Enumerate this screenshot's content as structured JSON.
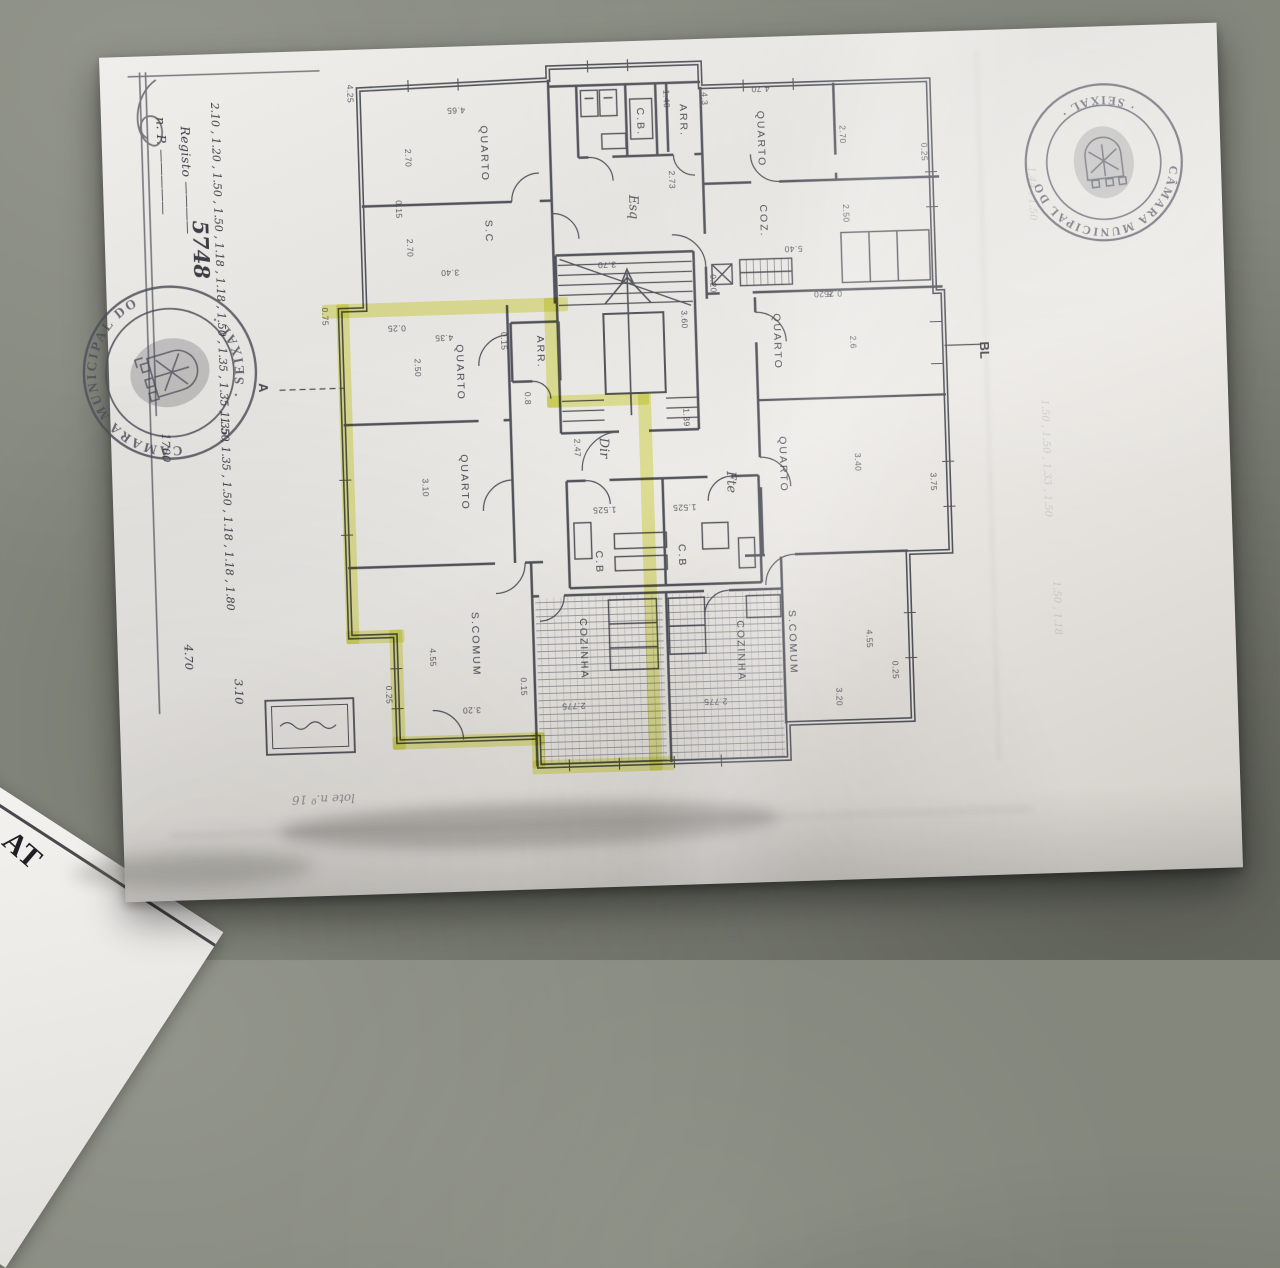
{
  "scene": {
    "description": "photocopied apartment floor plan on grey floor",
    "floor_color": "#84877c",
    "paper_color": "#e8e6e2",
    "ink_color": "#3c3e48",
    "highlight_color": "#dde049"
  },
  "registration": {
    "line1": "n. P.",
    "line2": "Registo",
    "number": "5748"
  },
  "stamps": {
    "left": {
      "arc_top": "CÂMARA MUNICIPAL DO",
      "arc_bottom": "· SEIXAL ·"
    },
    "right": {
      "arc_top": "CÂMARA MUNICIPAL DO",
      "arc_bottom": "· SEIXAL ·"
    }
  },
  "margin": {
    "column_upper": "2.10 , 1.20 , 1.50 , 1.50 , 1.18 , 1.18 , 1.50 , 1.35 , 1.35 , 1.50",
    "column_mid": "1700",
    "column_lower": "1.35 , 1.35 , 1.50 , 1.18 , 1.18 , 1.80",
    "left_bottom_1": "4.70",
    "left_bottom_2": "3.10",
    "faint_notes": [
      {
        "t": "1.50 , 1.50 , 1.33 , 1.50",
        "x": 1046,
        "y": 470
      },
      {
        "t": "1.44 , 1.50",
        "x": 1040,
        "y": 205
      },
      {
        "t": "1.50 , 1.18",
        "x": 1052,
        "y": 620
      }
    ]
  },
  "markers": {
    "section": "A",
    "block": "BL",
    "lot": "lote n.º 16"
  },
  "at_document": {
    "heading": "AT",
    "fragments": [
      "idade",
      "aneir"
    ]
  },
  "plan": {
    "rooms": [
      {
        "t": "QUARTO",
        "x": 494,
        "y": 148,
        "r": 90
      },
      {
        "t": "S.C",
        "x": 496,
        "y": 226,
        "r": 90
      },
      {
        "t": "C.B.",
        "x": 651,
        "y": 121,
        "r": 90
      },
      {
        "t": "ARR.",
        "x": 694,
        "y": 121,
        "r": 90
      },
      {
        "t": "QUARTO",
        "x": 771,
        "y": 142,
        "r": 90
      },
      {
        "t": "COZ.",
        "x": 771,
        "y": 224,
        "r": 90
      },
      {
        "t": "QUARTO",
        "x": 463,
        "y": 366,
        "r": 90
      },
      {
        "t": "QUARTO",
        "x": 464,
        "y": 476,
        "r": 90
      },
      {
        "t": "ARR.",
        "x": 544,
        "y": 348,
        "r": 90
      },
      {
        "t": "QUARTO",
        "x": 781,
        "y": 345,
        "r": 90
      },
      {
        "t": "QUARTO",
        "x": 783,
        "y": 468,
        "r": 90
      },
      {
        "t": "C.B",
        "x": 596,
        "y": 560,
        "r": 90
      },
      {
        "t": "C.B",
        "x": 679,
        "y": 556,
        "r": 90
      },
      {
        "t": "S.COMUM",
        "x": 470,
        "y": 638,
        "r": 90
      },
      {
        "t": "COZINHA",
        "x": 578,
        "y": 646,
        "r": 90
      },
      {
        "t": "COZINHA",
        "x": 735,
        "y": 653,
        "r": 90
      },
      {
        "t": "S.COMUM",
        "x": 787,
        "y": 646,
        "r": 90
      }
    ],
    "dimensions": [
      {
        "t": "4.25",
        "x": 362,
        "y": 84,
        "r": 90
      },
      {
        "t": "4.65",
        "x": 467,
        "y": 104,
        "r": 180
      },
      {
        "t": "2.70",
        "x": 418,
        "y": 150,
        "r": 90
      },
      {
        "t": "0.15",
        "x": 407,
        "y": 201,
        "r": 90
      },
      {
        "t": "2.70",
        "x": 417,
        "y": 240,
        "r": 90
      },
      {
        "t": "3.40",
        "x": 456,
        "y": 266,
        "r": 180
      },
      {
        "t": "1.40",
        "x": 678,
        "y": 99,
        "r": 90
      },
      {
        "t": "2.73",
        "x": 681,
        "y": 180,
        "r": 90
      },
      {
        "t": "4.3",
        "x": 716,
        "y": 100,
        "r": 90
      },
      {
        "t": "4.70",
        "x": 772,
        "y": 92,
        "r": 180
      },
      {
        "t": "2.70",
        "x": 853,
        "y": 140,
        "r": 90
      },
      {
        "t": "5.40",
        "x": 800,
        "y": 253,
        "r": 180
      },
      {
        "t": "2.50",
        "x": 854,
        "y": 219,
        "r": 90
      },
      {
        "t": "0.20",
        "x": 719,
        "y": 285,
        "r": 90
      },
      {
        "t": "6.20",
        "x": 828,
        "y": 299,
        "r": 180
      },
      {
        "t": "0.25",
        "x": 934,
        "y": 160,
        "r": 90
      },
      {
        "t": "3.70",
        "x": 613,
        "y": 263,
        "r": 180
      },
      {
        "t": "3.60",
        "x": 689,
        "y": 320,
        "r": 90
      },
      {
        "t": "1.39",
        "x": 688,
        "y": 418,
        "r": 90
      },
      {
        "t": "0.75",
        "x": 330,
        "y": 306,
        "r": 90
      },
      {
        "t": "0.25",
        "x": 401,
        "y": 320,
        "r": 180
      },
      {
        "t": "4.35",
        "x": 448,
        "y": 331,
        "r": 180
      },
      {
        "t": "2.50",
        "x": 421,
        "y": 360,
        "r": 90
      },
      {
        "t": "0.15",
        "x": 508,
        "y": 336,
        "r": 90
      },
      {
        "t": "0.8",
        "x": 530,
        "y": 394,
        "r": 90
      },
      {
        "t": "3.10",
        "x": 425,
        "y": 480,
        "r": 90
      },
      {
        "t": "0.25",
        "x": 838,
        "y": 299,
        "r": 180
      },
      {
        "t": "2.6",
        "x": 857,
        "y": 348,
        "r": 90
      },
      {
        "t": "3.40",
        "x": 858,
        "y": 468,
        "r": 90
      },
      {
        "t": "3.75",
        "x": 933,
        "y": 490,
        "r": 90
      },
      {
        "t": "2.47",
        "x": 578,
        "y": 445,
        "r": 90
      },
      {
        "t": "1.525",
        "x": 603,
        "y": 508,
        "r": 180
      },
      {
        "t": "1.525",
        "x": 683,
        "y": 508,
        "r": 180
      },
      {
        "t": "4.55",
        "x": 427,
        "y": 650,
        "r": 90
      },
      {
        "t": "0.15",
        "x": 517,
        "y": 682,
        "r": 90
      },
      {
        "t": "3.20",
        "x": 464,
        "y": 704,
        "r": 180
      },
      {
        "t": "2.775",
        "x": 566,
        "y": 703,
        "r": 180
      },
      {
        "t": "2.775",
        "x": 708,
        "y": 703,
        "r": 180
      },
      {
        "t": "4.55",
        "x": 864,
        "y": 645,
        "r": 90
      },
      {
        "t": "0.25",
        "x": 889,
        "y": 677,
        "r": 90
      },
      {
        "t": "3.20",
        "x": 832,
        "y": 702,
        "r": 90
      },
      {
        "t": "0.25",
        "x": 382,
        "y": 686,
        "r": 90
      }
    ],
    "hand_notes": [
      {
        "t": "Esq",
        "x": 641,
        "y": 206,
        "r": 90
      },
      {
        "t": "Dir",
        "x": 604,
        "y": 446,
        "r": 90
      },
      {
        "t": "Fte",
        "x": 730,
        "y": 484,
        "r": 90
      }
    ],
    "highlights": [
      {
        "x": 327,
        "y": 294,
        "w": 246,
        "h": 14
      },
      {
        "x": 341,
        "y": 294,
        "w": 13,
        "h": 340
      },
      {
        "x": 341,
        "y": 621,
        "w": 58,
        "h": 13
      },
      {
        "x": 384,
        "y": 621,
        "w": 13,
        "h": 120
      },
      {
        "x": 384,
        "y": 728,
        "w": 152,
        "h": 13
      },
      {
        "x": 523,
        "y": 728,
        "w": 13,
        "h": 36
      },
      {
        "x": 523,
        "y": 756,
        "w": 142,
        "h": 14
      },
      {
        "x": 549,
        "y": 294,
        "w": 13,
        "h": 110
      },
      {
        "x": 549,
        "y": 392,
        "w": 102,
        "h": 12
      },
      {
        "x": 640,
        "y": 392,
        "w": 13,
        "h": 378
      }
    ]
  }
}
